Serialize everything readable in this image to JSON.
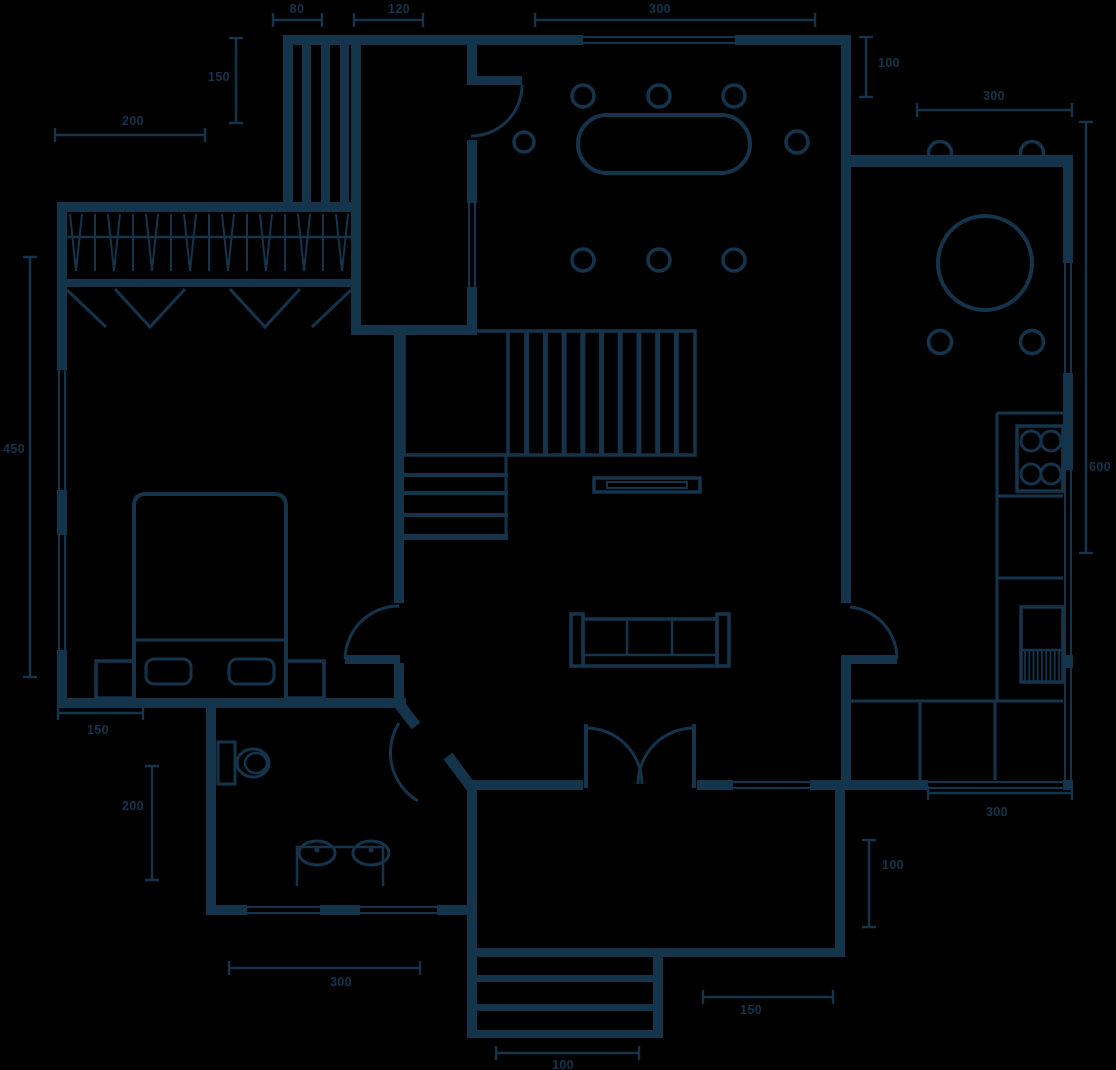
{
  "title": "house-floor-plan",
  "colors": {
    "line": "#14344c",
    "background": "#000000"
  },
  "dimensions": [
    {
      "name": "dim-closet-top",
      "value": "80",
      "o": "h",
      "a": 273,
      "b": 322,
      "c": 20,
      "lx": 297,
      "ly": 9
    },
    {
      "name": "dim-mudroom-top",
      "value": "120",
      "o": "h",
      "a": 354,
      "b": 423,
      "c": 20,
      "lx": 399,
      "ly": 9
    },
    {
      "name": "dim-dining-top",
      "value": "300",
      "o": "h",
      "a": 535,
      "b": 815,
      "c": 20,
      "lx": 660,
      "ly": 9
    },
    {
      "name": "dim-closet-left",
      "value": "150",
      "o": "v",
      "a": 38,
      "b": 123,
      "c": 236,
      "lx": 219,
      "ly": 77
    },
    {
      "name": "dim-upper-left",
      "value": "200",
      "o": "h",
      "a": 55,
      "b": 205,
      "c": 135,
      "lx": 133,
      "ly": 121
    },
    {
      "name": "dim-dining-right",
      "value": "100",
      "o": "v",
      "a": 37,
      "b": 97,
      "c": 866,
      "lx": 889,
      "ly": 63
    },
    {
      "name": "dim-kitchen-top",
      "value": "300",
      "o": "h",
      "a": 917,
      "b": 1072,
      "c": 110,
      "lx": 994,
      "ly": 96
    },
    {
      "name": "dim-kitchen-right",
      "value": "600",
      "o": "v",
      "a": 122,
      "b": 553,
      "c": 1086,
      "lx": 1100,
      "ly": 467
    },
    {
      "name": "dim-bedroom-left",
      "value": "450",
      "o": "v",
      "a": 257,
      "b": 677,
      "c": 30,
      "lx": 14,
      "ly": 449
    },
    {
      "name": "dim-bed-bottom",
      "value": "150",
      "o": "h",
      "a": 58,
      "b": 143,
      "c": 713,
      "lx": 98,
      "ly": 730
    },
    {
      "name": "dim-bathroom-left",
      "value": "200",
      "o": "v",
      "a": 766,
      "b": 880,
      "c": 152,
      "lx": 133,
      "ly": 806
    },
    {
      "name": "dim-bathroom-bottom",
      "value": "300",
      "o": "h",
      "a": 229,
      "b": 420,
      "c": 968,
      "lx": 341,
      "ly": 982
    },
    {
      "name": "dim-entry-right",
      "value": "150",
      "o": "h",
      "a": 703,
      "b": 833,
      "c": 997,
      "lx": 751,
      "ly": 1010
    },
    {
      "name": "dim-kitchen-low-right",
      "value": "100",
      "o": "v",
      "a": 840,
      "b": 927,
      "c": 869,
      "lx": 893,
      "ly": 865
    },
    {
      "name": "dim-kitchen-bottom",
      "value": "300",
      "o": "h",
      "a": 928,
      "b": 1072,
      "c": 793,
      "lx": 997,
      "ly": 812
    },
    {
      "name": "dim-porch-steps",
      "value": "100",
      "o": "h",
      "a": 496,
      "b": 639,
      "c": 1053,
      "lx": 563,
      "ly": 1065
    }
  ]
}
